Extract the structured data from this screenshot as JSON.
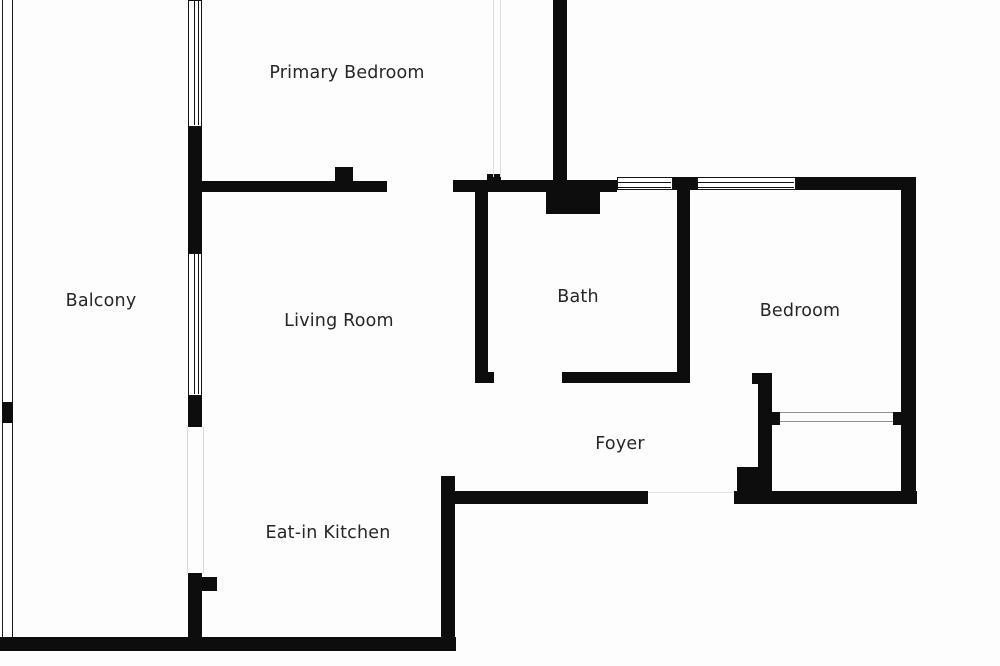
{
  "canvas": {
    "width": 1000,
    "height": 666,
    "background": "#fdfdfd"
  },
  "colors": {
    "wall": "#0d0d0d",
    "label": "#262626",
    "window_frame": "#141414",
    "faint_opening": "#dddddd",
    "closet_line": "#909090"
  },
  "rooms": [
    {
      "id": "primary-bedroom",
      "label": "Primary Bedroom",
      "cx": 347,
      "cy": 73
    },
    {
      "id": "balcony",
      "label": "Balcony",
      "cx": 101,
      "cy": 301
    },
    {
      "id": "living-room",
      "label": "Living Room",
      "cx": 339,
      "cy": 321
    },
    {
      "id": "bath",
      "label": "Bath",
      "cx": 578,
      "cy": 297
    },
    {
      "id": "bedroom",
      "label": "Bedroom",
      "cx": 800,
      "cy": 311
    },
    {
      "id": "foyer",
      "label": "Foyer",
      "cx": 620,
      "cy": 444
    },
    {
      "id": "eat-in-kitchen",
      "label": "Eat-in Kitchen",
      "cx": 328,
      "cy": 533
    }
  ],
  "walls": [
    [
      553,
      0,
      14,
      191
    ],
    [
      202,
      181,
      185,
      11
    ],
    [
      335,
      167,
      18,
      15
    ],
    [
      453,
      180,
      164,
      12
    ],
    [
      487,
      174,
      14,
      7
    ],
    [
      546,
      191,
      54,
      23
    ],
    [
      672,
      177,
      25,
      13
    ],
    [
      795,
      177,
      121,
      13
    ],
    [
      901,
      177,
      15,
      327
    ],
    [
      188,
      126,
      14,
      128
    ],
    [
      188,
      396,
      14,
      31
    ],
    [
      188,
      573,
      14,
      78
    ],
    [
      202,
      577,
      15,
      14
    ],
    [
      2,
      402,
      11,
      21
    ],
    [
      0,
      637,
      456,
      14
    ],
    [
      441,
      476,
      14,
      175
    ],
    [
      455,
      491,
      193,
      13
    ],
    [
      475,
      192,
      13,
      191
    ],
    [
      475,
      372,
      19,
      11
    ],
    [
      562,
      372,
      128,
      11
    ],
    [
      677,
      190,
      13,
      193
    ],
    [
      758,
      373,
      14,
      131
    ],
    [
      752,
      373,
      7,
      11
    ],
    [
      772,
      412,
      8,
      13
    ],
    [
      893,
      412,
      9,
      13
    ],
    [
      737,
      467,
      35,
      37
    ],
    [
      734,
      491,
      183,
      13
    ]
  ],
  "windows": [
    {
      "x": 188,
      "y": 0,
      "w": 14,
      "h": 127,
      "orient": "v"
    },
    {
      "x": 188,
      "y": 253,
      "w": 14,
      "h": 143,
      "orient": "v"
    },
    {
      "x": 617,
      "y": 177,
      "w": 56,
      "h": 13,
      "orient": "h"
    },
    {
      "x": 697,
      "y": 177,
      "w": 99,
      "h": 13,
      "orient": "h"
    }
  ],
  "balcony_rail": [
    2,
    0,
    11,
    641
  ],
  "faint_lines": [
    {
      "rect": [
        493,
        0,
        1,
        177
      ],
      "color": "#dddddd"
    },
    {
      "rect": [
        500,
        0,
        1,
        177
      ],
      "color": "#dddddd"
    },
    {
      "rect": [
        187,
        427,
        1,
        146
      ],
      "color": "#d8d8d8"
    },
    {
      "rect": [
        203,
        427,
        1,
        146
      ],
      "color": "#d8d8d8"
    },
    {
      "rect": [
        648,
        492,
        86,
        1
      ],
      "color": "#e3e3e3"
    },
    {
      "rect": [
        780,
        412,
        113,
        1
      ],
      "color": "#909090"
    },
    {
      "rect": [
        780,
        421,
        113,
        1
      ],
      "color": "#909090"
    }
  ]
}
